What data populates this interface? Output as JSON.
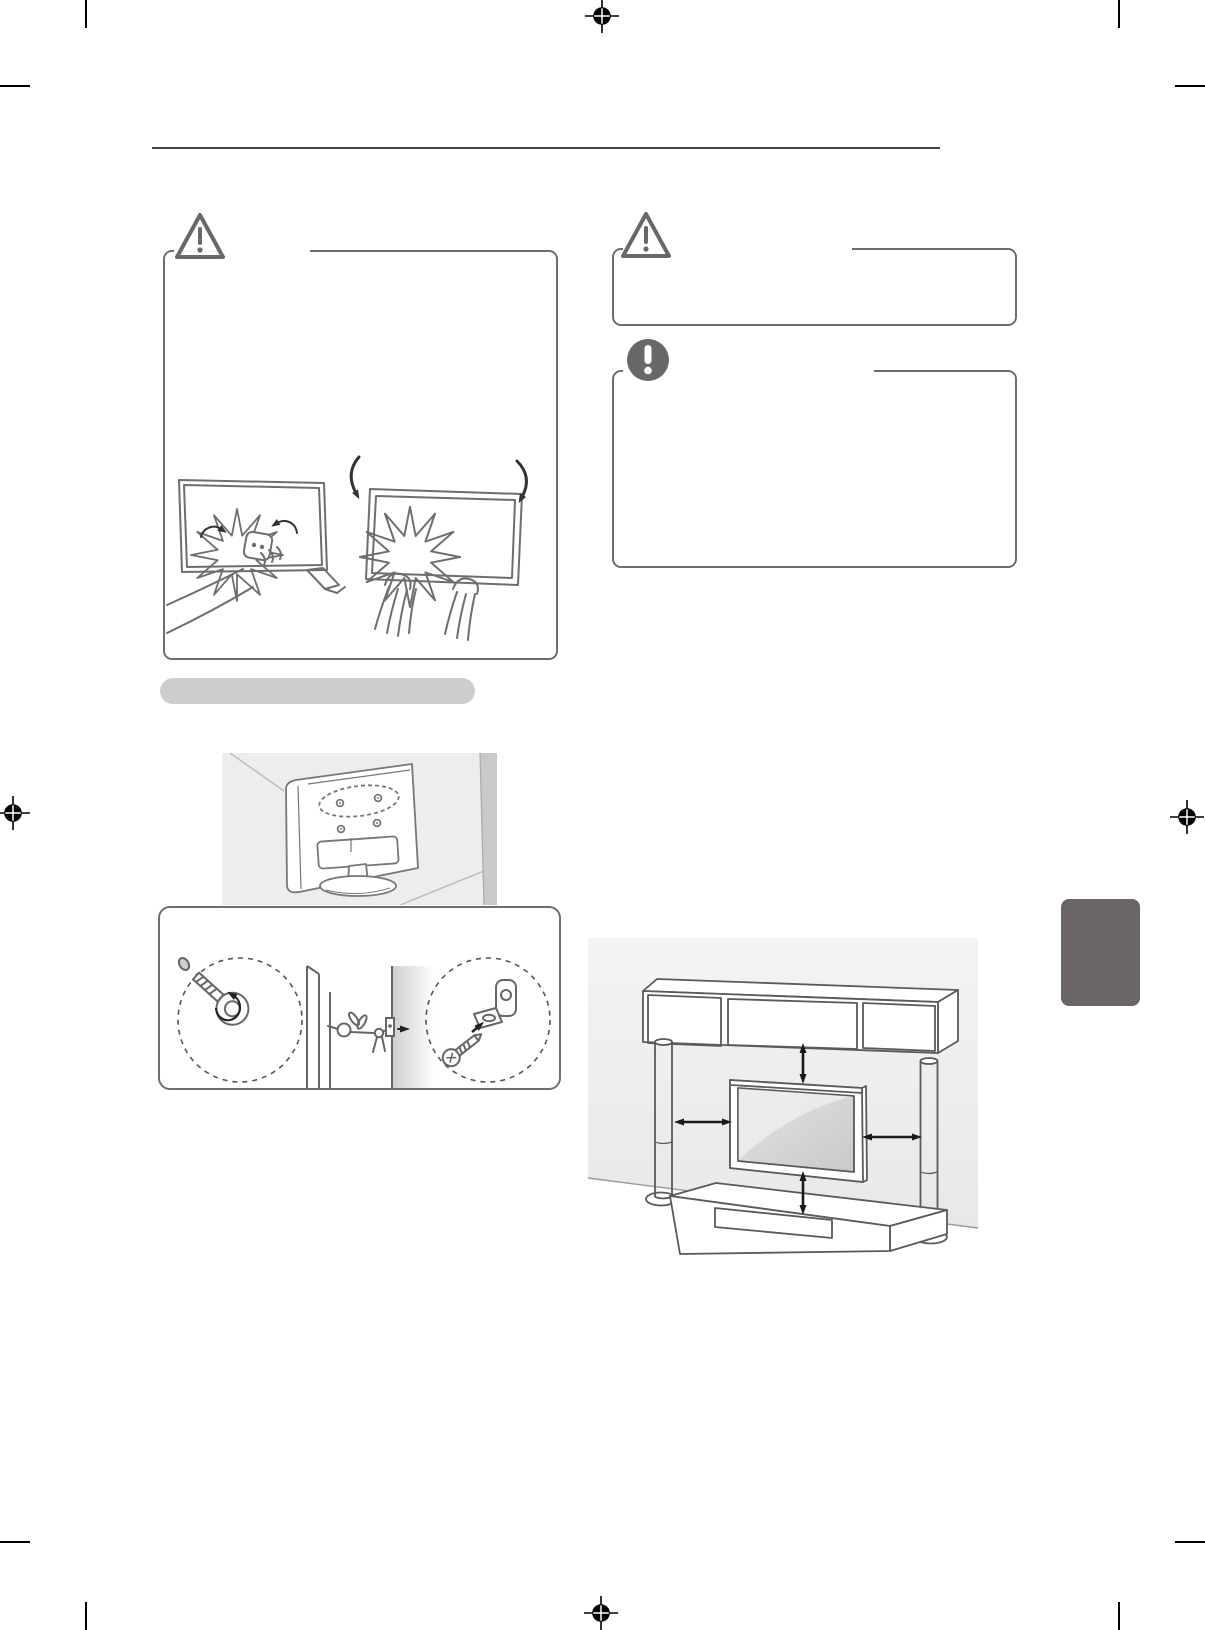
{
  "page": {
    "kind": "printed-manual-page-graphics-only",
    "background": "#ffffff"
  },
  "colors": {
    "line_art": "#6e6e6e",
    "divider_rule": "#454545",
    "section_bar": "#cdcdcd",
    "callout_box_border": "#6e6e6e",
    "warning_icon": "#686868",
    "note_icon": "#686868",
    "side_tab": "#6b6566",
    "illustration_background": "#ededed",
    "wall_shading": "#c9c9c9",
    "arrow": "#1a1a1a",
    "print_marks": "#000000"
  },
  "boxes": {
    "caution_left": {
      "icon": "warning-triangle-icon",
      "label": ""
    },
    "caution_right": {
      "icon": "warning-triangle-icon",
      "label": ""
    },
    "note": {
      "icon": "exclamation-circle-icon",
      "label": ""
    }
  },
  "section_bar": {
    "label": ""
  },
  "side_tab": {
    "label": ""
  },
  "illustrations": {
    "screen_pressure": "Two TVs with impact starbursts: a hand wiping or pressing the screen and two hands grasping the panel, with rotation arrows",
    "wall_corner": "Rear view of a TV on a stand facing a wall corner, VESA screw holes highlighted with a dashed ellipse",
    "anchor_hardware": "Eye-bolt callout and wall-bracket-with-screw callout; TV tethered to the wall with a sturdy cord",
    "clearance": "Wall-mounted TV between two tower speakers with a shelf above and a media console below, double arrows showing clearance on all four sides"
  },
  "print_marks": {
    "registration_targets": [
      "top-center",
      "bottom-center",
      "left-middle",
      "right-middle"
    ],
    "corner_crop_marks": [
      "top-left",
      "top-right",
      "bottom-left",
      "bottom-right"
    ]
  }
}
